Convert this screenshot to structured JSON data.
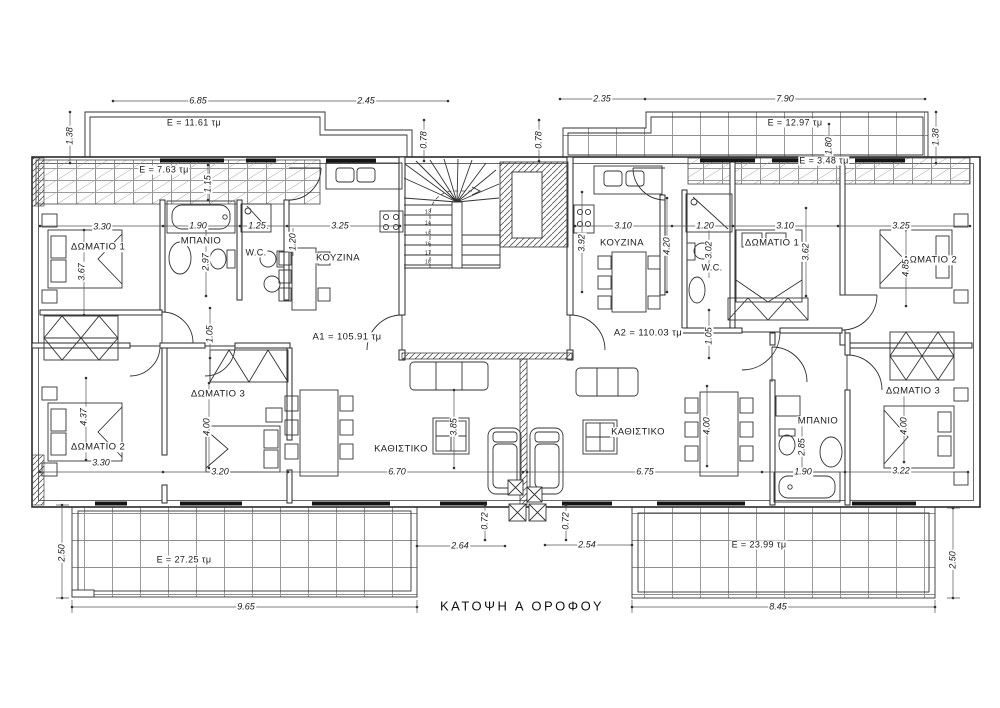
{
  "title": "ΚΑΤΟΨΗ Α ΟΡΟΦΟΥ",
  "labels": [
    {
      "n": "dim-top-a1-width",
      "t": "6.85",
      "x": 198,
      "y": 101
    },
    {
      "n": "dim-top-a1-right",
      "t": "2.45",
      "x": 366,
      "y": 101
    },
    {
      "n": "dim-top-a2-left",
      "t": "2.35",
      "x": 602,
      "y": 99
    },
    {
      "n": "dim-top-a2-width",
      "t": "7.90",
      "x": 785,
      "y": 99
    },
    {
      "n": "dim-balcony-tl-depth",
      "t": "1.38",
      "x": 70,
      "y": 136,
      "r": 1
    },
    {
      "n": "dim-balcony-tr-depth",
      "t": "1.38",
      "x": 936,
      "y": 137,
      "r": 1
    },
    {
      "n": "area-balcony-top-left",
      "t": "E = 11.61 τμ",
      "x": 194,
      "y": 123,
      "up": 1
    },
    {
      "n": "area-balcony-top-right",
      "t": "E = 12.97 τμ",
      "x": 795,
      "y": 123,
      "up": 1
    },
    {
      "n": "dim-offset-left",
      "t": "0.78",
      "x": 424,
      "y": 140,
      "r": 1
    },
    {
      "n": "dim-offset-right",
      "t": "0.78",
      "x": 539,
      "y": 140,
      "r": 1
    },
    {
      "n": "area-veranda-left",
      "t": "E = 7.63 τμ",
      "x": 164,
      "y": 170,
      "up": 1
    },
    {
      "n": "area-veranda-right",
      "t": "E = 3.48 τμ",
      "x": 824,
      "y": 161,
      "up": 1
    },
    {
      "n": "dim-veranda-left-depth",
      "t": "1.15",
      "x": 208,
      "y": 184,
      "r": 1
    },
    {
      "n": "dim-veranda-right-depth",
      "t": "1.80",
      "x": 829,
      "y": 146,
      "r": 1
    },
    {
      "n": "dim-a1-bed1-width",
      "t": "3.30",
      "x": 102,
      "y": 227
    },
    {
      "n": "dim-a1-bath-width",
      "t": "1.90",
      "x": 198,
      "y": 226
    },
    {
      "n": "dim-a1-wc-width",
      "t": "1.25",
      "x": 257,
      "y": 226
    },
    {
      "n": "dim-a1-kitchen-width",
      "t": "3.25",
      "x": 340,
      "y": 226
    },
    {
      "n": "dim-a2-kitchen-width",
      "t": "3.10",
      "x": 623,
      "y": 226
    },
    {
      "n": "dim-a2-wc-width",
      "t": "1.20",
      "x": 705,
      "y": 226
    },
    {
      "n": "dim-a2-bed1-width",
      "t": "3.10",
      "x": 785,
      "y": 226
    },
    {
      "n": "dim-a2-bed2-width",
      "t": "3.25",
      "x": 901,
      "y": 226
    },
    {
      "n": "room-a1-bedroom1",
      "t": "ΔΩΜΑΤΙΟ 1",
      "x": 98,
      "y": 247,
      "up": 1,
      "s": 9.5
    },
    {
      "n": "room-a1-bathroom",
      "t": "ΜΠΑΝΙΟ",
      "x": 201,
      "y": 241,
      "up": 1,
      "s": 9.5
    },
    {
      "n": "room-a1-wc",
      "t": "W.C.",
      "x": 256,
      "y": 253,
      "up": 1,
      "s": 9
    },
    {
      "n": "room-a1-kitchen",
      "t": "ΚΟΥΖΙΝΑ",
      "x": 338,
      "y": 258,
      "up": 1,
      "s": 9.5
    },
    {
      "n": "room-a2-kitchen",
      "t": "ΚΟΥΖΙΝΑ",
      "x": 622,
      "y": 243,
      "up": 1,
      "s": 9.5
    },
    {
      "n": "room-a2-wc",
      "t": "W.C.",
      "x": 712,
      "y": 268,
      "up": 1,
      "s": 9
    },
    {
      "n": "room-a2-bedroom1",
      "t": "ΔΩΜΑΤΙΟ 1",
      "x": 772,
      "y": 243,
      "up": 1,
      "s": 9.5
    },
    {
      "n": "room-a2-bedroom2",
      "t": "ΔΩΜΑΤΙΟ 2",
      "x": 930,
      "y": 260,
      "up": 1,
      "s": 9.5
    },
    {
      "n": "dim-a1-bed1-depth",
      "t": "3.67",
      "x": 82,
      "y": 272,
      "r": 1
    },
    {
      "n": "dim-a1-bath-depth",
      "t": "2.97",
      "x": 206,
      "y": 262,
      "r": 1
    },
    {
      "n": "dim-a1-wc-depth",
      "t": "1.20",
      "x": 293,
      "y": 242,
      "r": 1
    },
    {
      "n": "dim-a2-kitchen-depth",
      "t": "3.92",
      "x": 582,
      "y": 243,
      "r": 1
    },
    {
      "n": "dim-a2-hall-depth",
      "t": "4.20",
      "x": 667,
      "y": 246,
      "r": 1
    },
    {
      "n": "dim-a2-wc-depth",
      "t": "3.02",
      "x": 709,
      "y": 250,
      "r": 1
    },
    {
      "n": "dim-a2-bed1-depth",
      "t": "3.62",
      "x": 806,
      "y": 252,
      "r": 1
    },
    {
      "n": "dim-a2-bed2-depth",
      "t": "4.85",
      "x": 906,
      "y": 268,
      "r": 1
    },
    {
      "n": "area-apartment-a1",
      "t": "A1 = 105.91 τμ",
      "x": 347,
      "y": 337,
      "up": 1,
      "s": 9.5
    },
    {
      "n": "area-apartment-a2",
      "t": "A2 = 110.03 τμ",
      "x": 648,
      "y": 333,
      "up": 1,
      "s": 9.5
    },
    {
      "n": "dim-a1-hall",
      "t": "1.05",
      "x": 210,
      "y": 334,
      "r": 1
    },
    {
      "n": "dim-a2-hall",
      "t": "1.05",
      "x": 709,
      "y": 336,
      "r": 1
    },
    {
      "n": "room-a1-bedroom3",
      "t": "ΔΩΜΑΤΙΟ 3",
      "x": 218,
      "y": 394,
      "up": 1,
      "s": 9.5
    },
    {
      "n": "room-a1-bedroom2",
      "t": "ΔΩΜΑΤΙΟ 2",
      "x": 98,
      "y": 447,
      "up": 1,
      "s": 9.5
    },
    {
      "n": "dim-a1-bed2-depth",
      "t": "4.37",
      "x": 84,
      "y": 417,
      "r": 1
    },
    {
      "n": "dim-a1-bed3-depth",
      "t": "4.00",
      "x": 207,
      "y": 427,
      "r": 1
    },
    {
      "n": "dim-a1-bed2-width",
      "t": "3.30",
      "x": 101,
      "y": 463
    },
    {
      "n": "dim-a1-bed3-width",
      "t": "3.20",
      "x": 220,
      "y": 472
    },
    {
      "n": "room-a1-living",
      "t": "ΚΑΘΙΣΤΙΚΟ",
      "x": 401,
      "y": 449,
      "up": 1,
      "s": 9.5
    },
    {
      "n": "dim-a1-living-depth",
      "t": "3.85",
      "x": 454,
      "y": 427,
      "r": 1
    },
    {
      "n": "dim-a1-living-width",
      "t": "6.70",
      "x": 397,
      "y": 472
    },
    {
      "n": "room-a2-living",
      "t": "ΚΑΘΙΣΤΙΚΟ",
      "x": 638,
      "y": 432,
      "up": 1,
      "s": 9.5
    },
    {
      "n": "dim-a2-living-width",
      "t": "6.75",
      "x": 645,
      "y": 472
    },
    {
      "n": "dim-a2-living-depth",
      "t": "4.00",
      "x": 707,
      "y": 426,
      "r": 1
    },
    {
      "n": "room-a2-bathroom",
      "t": "ΜΠΑΝΙΟ",
      "x": 818,
      "y": 421,
      "up": 1,
      "s": 9.5
    },
    {
      "n": "dim-a2-bath-depth",
      "t": "2.85",
      "x": 802,
      "y": 447,
      "r": 1
    },
    {
      "n": "dim-a2-bath-width",
      "t": "1.90",
      "x": 803,
      "y": 472
    },
    {
      "n": "room-a2-bedroom3",
      "t": "ΔΩΜΑΤΙΟ 3",
      "x": 913,
      "y": 391,
      "up": 1,
      "s": 9.5
    },
    {
      "n": "dim-a2-bed3-depth",
      "t": "4.00",
      "x": 904,
      "y": 426,
      "r": 1
    },
    {
      "n": "dim-a2-bed3-width",
      "t": "3.22",
      "x": 901,
      "y": 471
    },
    {
      "n": "dim-entry-col-left",
      "t": "0.72",
      "x": 485,
      "y": 521,
      "r": 1
    },
    {
      "n": "dim-entry-col-right",
      "t": "0.72",
      "x": 566,
      "y": 521,
      "r": 1
    },
    {
      "n": "dim-entry-a1",
      "t": "2.64",
      "x": 460,
      "y": 546
    },
    {
      "n": "dim-entry-a2",
      "t": "2.54",
      "x": 587,
      "y": 545
    },
    {
      "n": "area-balcony-bottom-left",
      "t": "E = 27.25 τμ",
      "x": 184,
      "y": 560,
      "up": 1
    },
    {
      "n": "area-balcony-bottom-right",
      "t": "E = 23.99 τμ",
      "x": 759,
      "y": 545,
      "up": 1
    },
    {
      "n": "dim-balcony-bl-depth",
      "t": "2.50",
      "x": 62,
      "y": 553,
      "r": 1
    },
    {
      "n": "dim-balcony-br-depth",
      "t": "2.50",
      "x": 953,
      "y": 560,
      "r": 1
    },
    {
      "n": "dim-balcony-bl-width",
      "t": "9.65",
      "x": 246,
      "y": 607
    },
    {
      "n": "dim-balcony-br-width",
      "t": "8.45",
      "x": 778,
      "y": 607
    },
    {
      "n": "stair-step-13",
      "t": "13",
      "x": 428,
      "y": 213,
      "s": 5,
      "up": 1,
      "nb": 1
    },
    {
      "n": "stair-step-14",
      "t": "14",
      "x": 428,
      "y": 224,
      "s": 5,
      "up": 1,
      "nb": 1
    },
    {
      "n": "stair-step-15",
      "t": "15",
      "x": 428,
      "y": 235,
      "s": 5,
      "up": 1,
      "nb": 1
    },
    {
      "n": "stair-step-16",
      "t": "16",
      "x": 428,
      "y": 245,
      "s": 5,
      "up": 1,
      "nb": 1
    },
    {
      "n": "stair-step-17",
      "t": "17",
      "x": 428,
      "y": 254,
      "s": 5,
      "up": 1,
      "nb": 1
    },
    {
      "n": "stair-step-18",
      "t": "18",
      "x": 428,
      "y": 263,
      "s": 5,
      "up": 1,
      "nb": 1
    }
  ]
}
